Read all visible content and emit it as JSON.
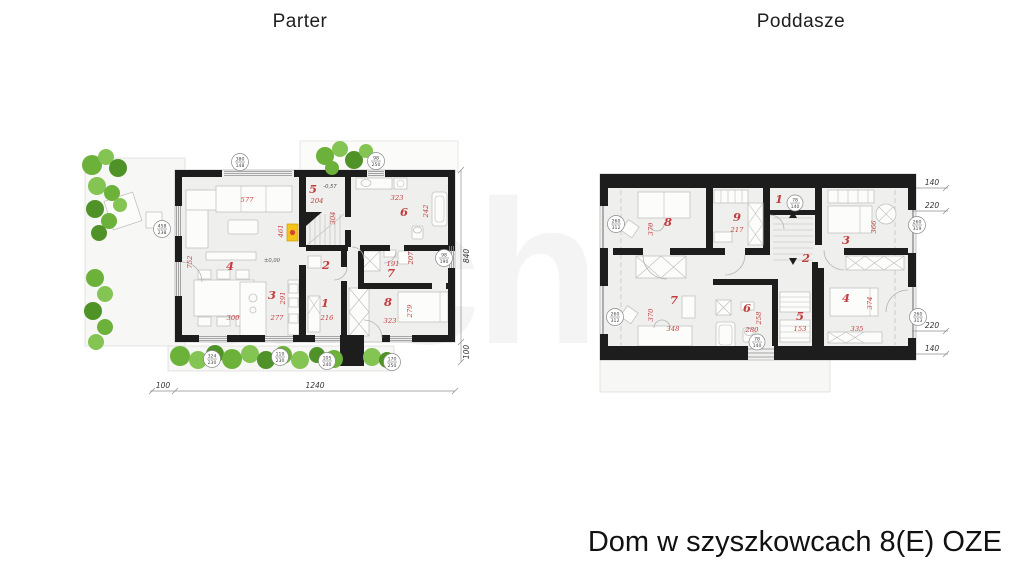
{
  "header": {
    "parter": "Parter",
    "poddasze": "Poddasze"
  },
  "footer": {
    "title": "Dom w szyszkowcach 8(E) OZE"
  },
  "watermark": {
    "text": "archon"
  },
  "parter": {
    "rooms": {
      "r1": "1",
      "r2": "2",
      "r3": "3",
      "r4": "4",
      "r5": "5",
      "r6": "6",
      "r7": "7",
      "r8": "8"
    },
    "dims": {
      "d577": "577",
      "d752": "752",
      "d461": "461",
      "d204": "204",
      "d304": "304",
      "d323a": "323",
      "d242": "242",
      "d191": "191",
      "d207": "207",
      "d300": "300",
      "d277": "277",
      "d291": "291",
      "d216": "216",
      "d323b": "323",
      "d279": "279"
    },
    "levels": {
      "zero": "±0,00",
      "minus": "-0,57"
    },
    "outer": {
      "a100": "100",
      "b1240": "1240",
      "c840": "840",
      "d100": "100"
    },
    "markers": [
      {
        "t": "380",
        "b": "148"
      },
      {
        "t": "98",
        "b": "250"
      },
      {
        "t": "458",
        "b": "238"
      },
      {
        "t": "324",
        "b": "230"
      },
      {
        "t": "110",
        "b": "230"
      },
      {
        "t": "105",
        "b": "240"
      },
      {
        "t": "170",
        "b": "250"
      },
      {
        "t": "98",
        "b": "190"
      }
    ]
  },
  "poddasze": {
    "rooms": {
      "r1": "1",
      "r2": "2",
      "r3": "3",
      "r4": "4",
      "r5": "5",
      "r6": "6",
      "r7": "7",
      "r8": "8",
      "r9": "9"
    },
    "dims": {
      "d370a": "370",
      "d217": "217",
      "d366": "366",
      "d370b": "370",
      "d348": "348",
      "d258": "258",
      "d280": "280",
      "d153": "153",
      "d374": "374",
      "d335": "335"
    },
    "side": {
      "s1": "140",
      "s2": "220",
      "s3": "220",
      "s4": "140"
    },
    "markers": [
      {
        "t": "260",
        "b": "312"
      },
      {
        "t": "260",
        "b": "312"
      },
      {
        "t": "260",
        "b": "319"
      },
      {
        "t": "260",
        "b": "313"
      },
      {
        "t": "78",
        "b": "140"
      },
      {
        "t": "78",
        "b": "140"
      }
    ]
  }
}
